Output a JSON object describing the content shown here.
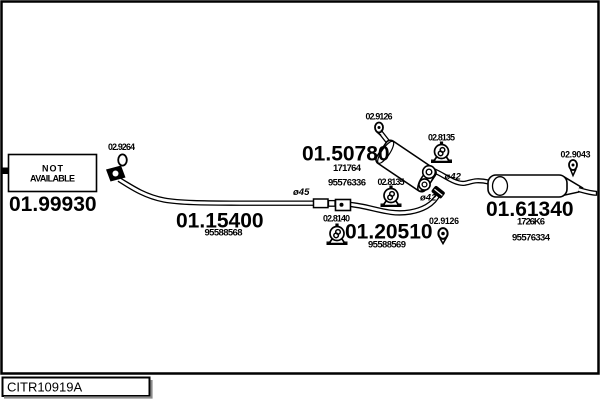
{
  "drawing_code": "CITR10919A",
  "not_available_box": {
    "line1": "NOT",
    "line2": "AVAILABLE"
  },
  "parts": {
    "front_pipe": {
      "number": "01.99930"
    },
    "center_pipe": {
      "number": "01.15400",
      "oe_ref": "95588568"
    },
    "middle_silencer": {
      "number": "01.50780",
      "oe_ref_1": "171764",
      "oe_ref_2": "95576336"
    },
    "connector_pipe": {
      "number": "01.20510",
      "oe_ref": "95588569"
    },
    "rear_silencer": {
      "number": "01.61340",
      "oe_ref_1": "1726K6",
      "oe_ref_2": "95576334"
    }
  },
  "fittings": {
    "clamp_front": {
      "number": "02.9264"
    },
    "clamp_middle_inlet": {
      "number": "02.9126"
    },
    "clamp_middle_outlet": {
      "number": "02.9126"
    },
    "hanger_middle_right": {
      "number": "02.8135"
    },
    "hanger_middle_left": {
      "number": "02.8135"
    },
    "hanger_connector": {
      "number": "02.8140"
    },
    "clamp_tail": {
      "number": "02.9043"
    }
  },
  "diameters": {
    "flange": "ø45",
    "outlet": "ø42",
    "inlet": "ø42"
  },
  "colors": {
    "line": "#000000",
    "background": "#ffffff"
  }
}
